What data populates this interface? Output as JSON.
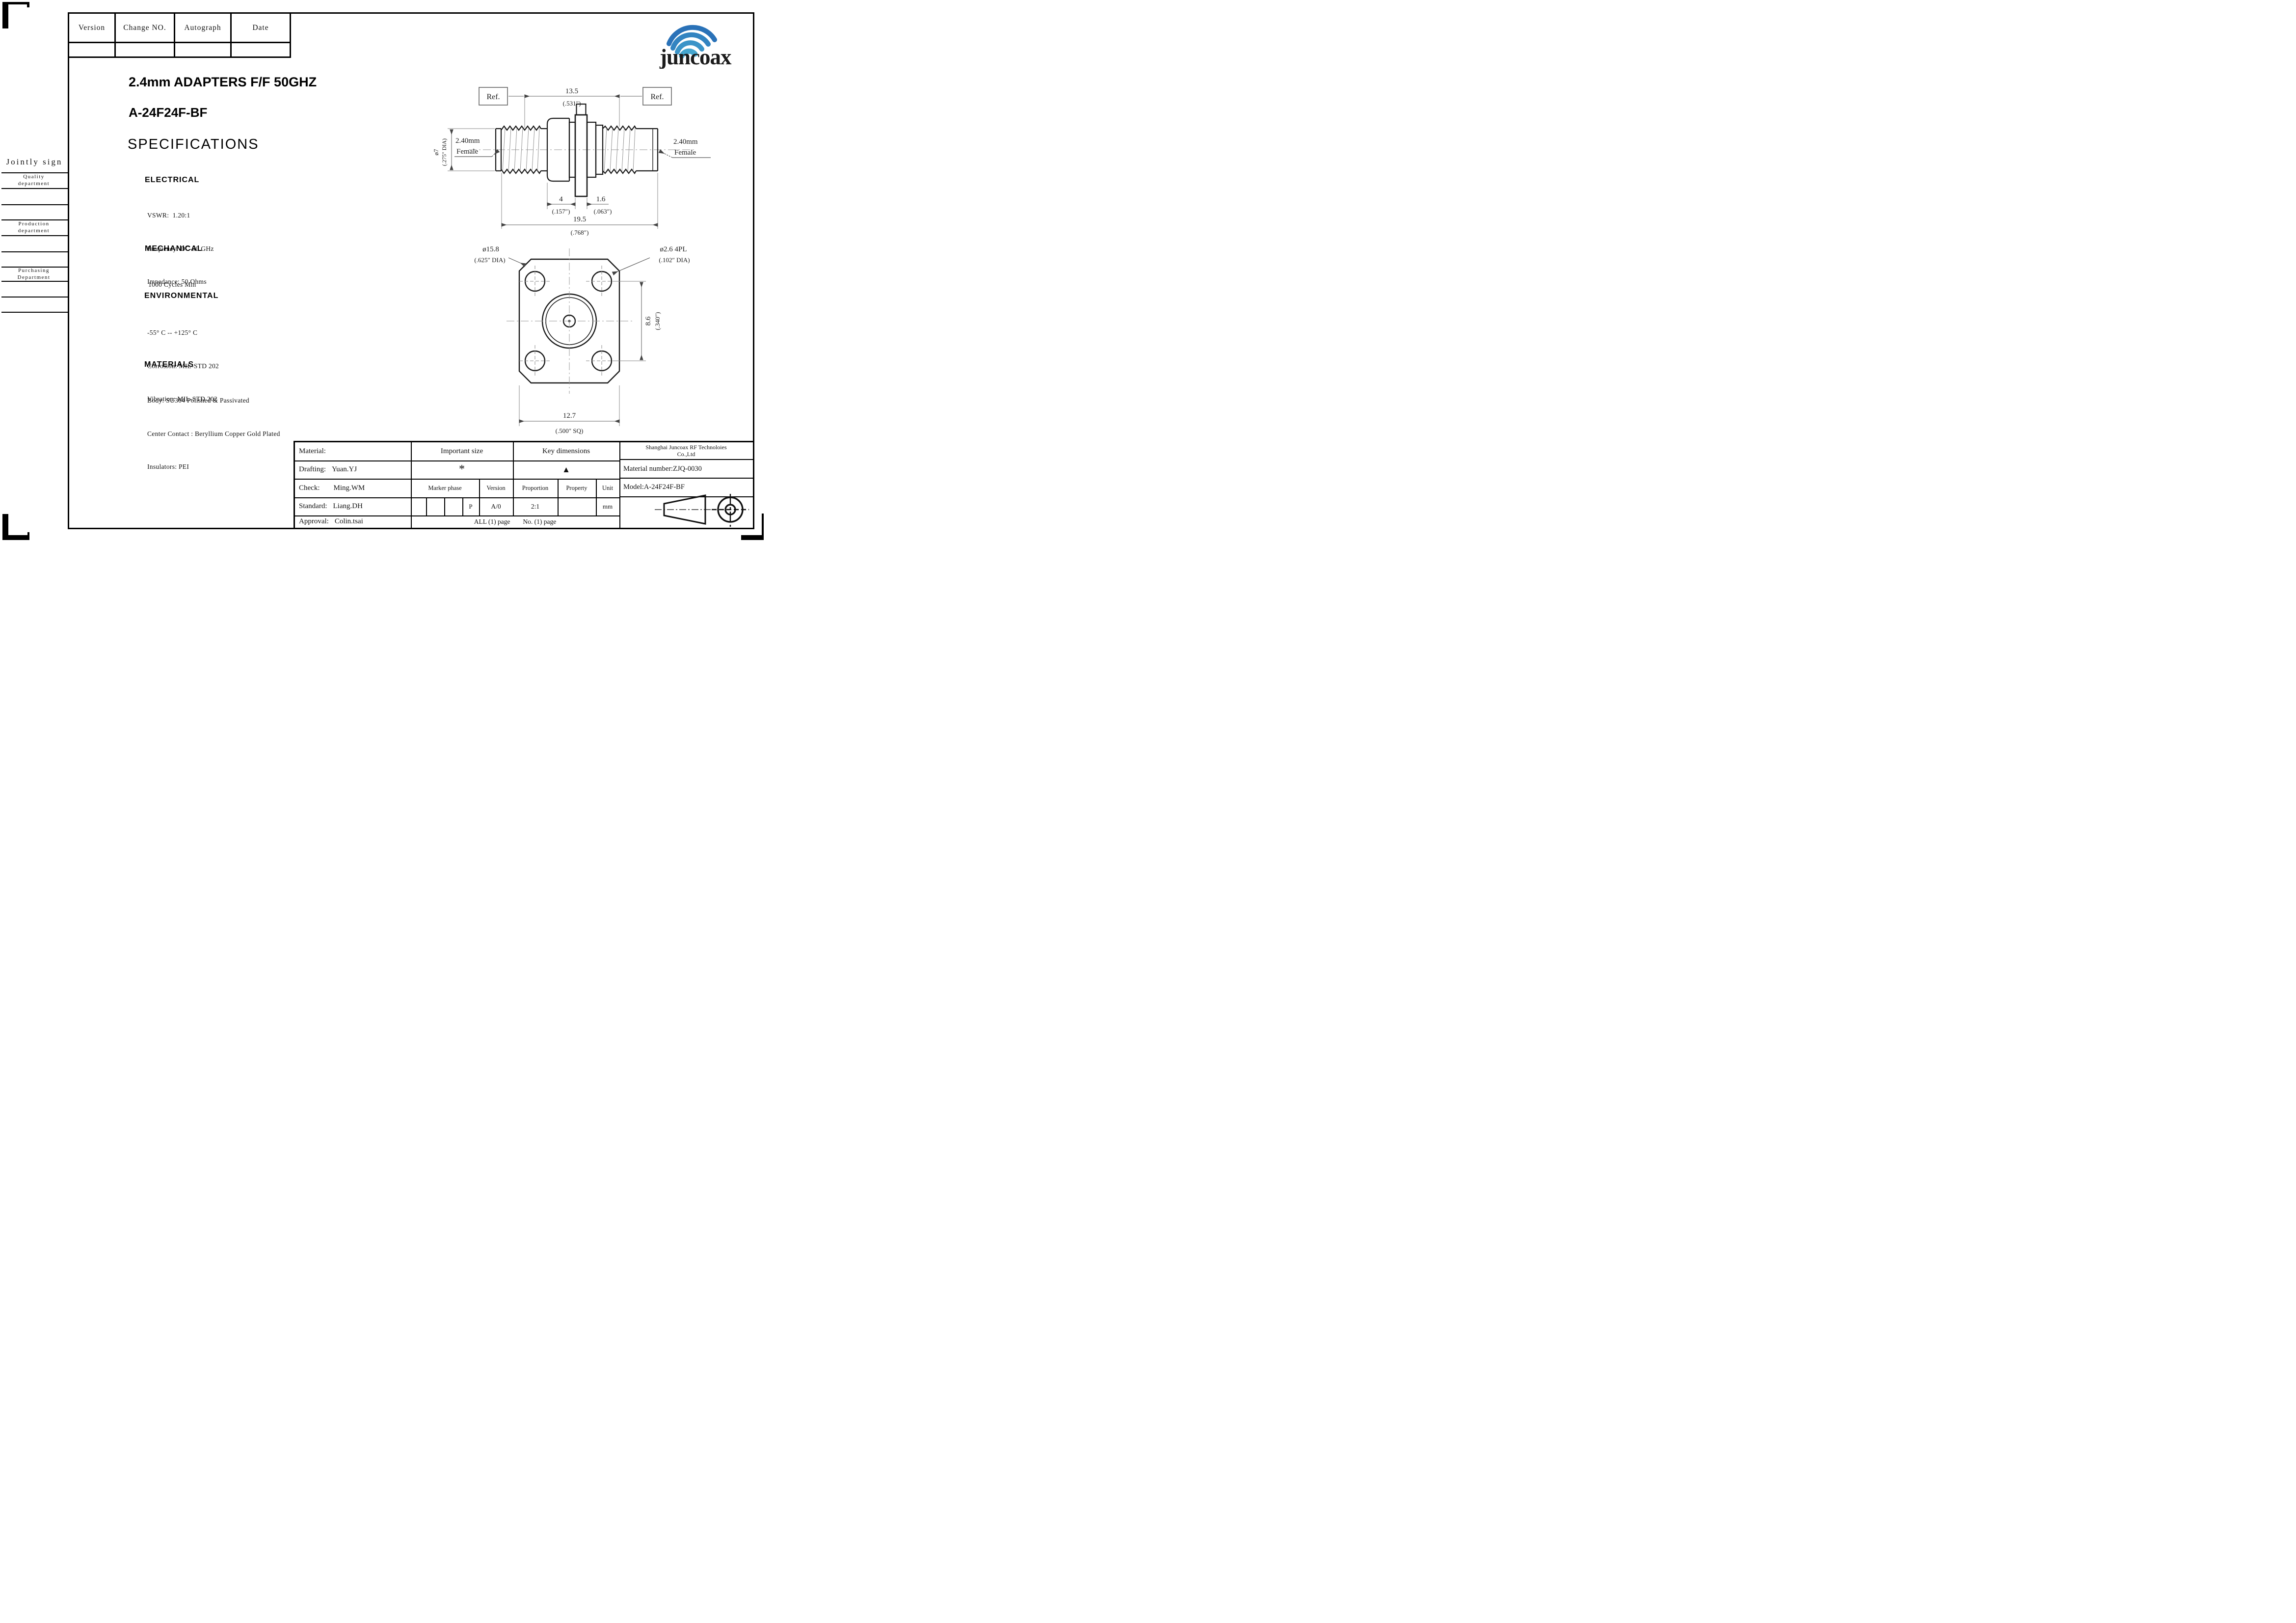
{
  "revision_table": {
    "headers": [
      "Version",
      "Change NO.",
      "Autograph",
      "Date"
    ]
  },
  "jointly_sign": {
    "title": "Jointly sign",
    "departments": [
      {
        "line1": "Quality",
        "line2": "department"
      },
      {
        "line1": "Production",
        "line2": "department"
      },
      {
        "line1": "Purchasing",
        "line2": "Department"
      }
    ]
  },
  "titles": {
    "product": "2.4mm ADAPTERS F/F 50GHZ",
    "model": "A-24F24F-BF",
    "section": "SPECIFICATIONS"
  },
  "specs": {
    "electrical": {
      "heading": "ELECTRICAL",
      "lines": [
        "VSWR:  1.20:1",
        "Frequency: DC-50 GHz",
        "Impedance: 50 Ohms"
      ]
    },
    "mechanical": {
      "heading": "MECHANICAL",
      "lines": [
        "1000 Cycles Min"
      ]
    },
    "environmental": {
      "heading": "ENVIRONMENTAL",
      "lines": [
        "-55° C -- +125° C",
        "Corrosion: MIL-STD 202",
        "Vibration: MIL-STD 202"
      ]
    },
    "materials": {
      "heading": "MATERIALS",
      "lines": [
        "Body: SU304 Polished & Passivated",
        "Center Contact : Beryllium Copper Gold Plated",
        "Insulators: PEI"
      ]
    }
  },
  "drawing": {
    "side": {
      "ref_left": "Ref.",
      "ref_right": "Ref.",
      "dim_len": "13.5",
      "dim_len_in": "(.531″)",
      "port_left_l1": "2.40mm",
      "port_left_l2": "Female",
      "port_right_l1": "2.40mm",
      "port_right_l2": "Female",
      "dia_body": "ø7",
      "dia_body_in": "(.275″ DIA)",
      "dim_nut": "4",
      "dim_nut_in": "(.157″)",
      "dim_flange": "1.6",
      "dim_flange_in": "(.063″)",
      "dim_total": "19.5",
      "dim_total_in": "(.768″)"
    },
    "front": {
      "dia_flange": "ø15.8",
      "dia_flange_in": "(.625″ DIA)",
      "dia_holes": "ø2.6 4PL",
      "dia_holes_in": "(.102″ DIA)",
      "dim_vert": "8.6",
      "dim_vert_in": "(.340″)",
      "dim_sq": "12.7",
      "dim_sq_in": "(.500″ SQ)"
    }
  },
  "title_block": {
    "material_label": "Material:",
    "drafting": {
      "label": "Drafting:",
      "value": "Yuan.YJ"
    },
    "check": {
      "label": "Check:",
      "value": "Ming.WM"
    },
    "standard": {
      "label": "Standard:",
      "value": "Liang.DH"
    },
    "approval": {
      "label": "Approval:",
      "value": "Colin.tsai"
    },
    "important_size": "Important size",
    "key_dimensions": "Key dimensions",
    "star": "*",
    "triangle": "▲",
    "marker_phase": "Marker phase",
    "version_h": "Version",
    "proportion_h": "Proportion",
    "property_h": "Property",
    "unit_h": "Unit",
    "p_mark": "P",
    "version_v": "A/0",
    "proportion_v": "2:1",
    "unit_v": "mm",
    "pages_all": "ALL (1) page",
    "pages_no": "No. (1) page",
    "company_l1": "Shanghai Juncoax RF Technoloies",
    "company_l2": "Co.,Ltd",
    "material_number": "Material number:ZJQ-0030",
    "model": "Model:A-24F24F-BF"
  },
  "logo": {
    "text": "juncoax",
    "color": "#2a72b8"
  }
}
